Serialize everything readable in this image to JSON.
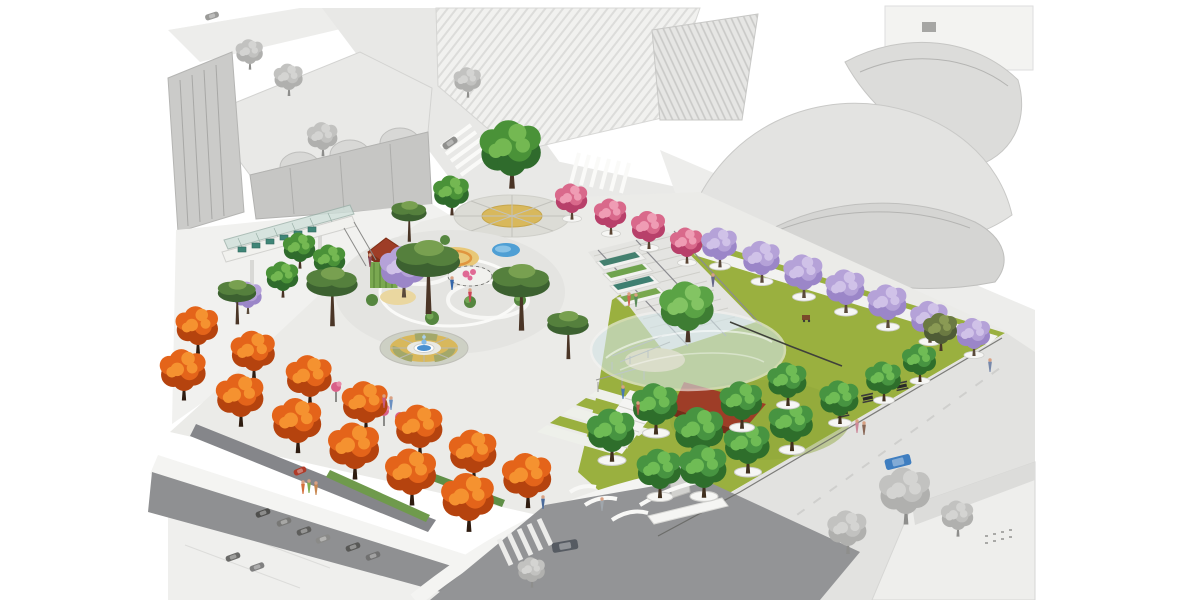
{
  "meta": {
    "title": "Aerial perspective rendering of an urban park masterplan",
    "style": "Colored park illustration over washed-out grayscale aerial photo context",
    "canvas": "1200x600"
  },
  "palette": {
    "background": "#ffffff",
    "context_gray": "#e3e3e1",
    "plaza": "#ebebe8",
    "pavement": "#f1f1ef",
    "lawn": "#9ab03f",
    "lawn_light": "#aec159",
    "street_dark": "#8f9092",
    "street_light": "#e2e2e0",
    "sidewalk": "#f4f4f2",
    "orange_foliage": "#e4641a",
    "green_foliage": "#479441",
    "jacaranda_purple": "#b5a2d8",
    "pink_blossom": "#d9698b",
    "pine_green": "#55803d",
    "canopy_glass": "#d3e4e6",
    "roof_red": "#9e3d27",
    "water_blue": "#4a90d0",
    "play_tan": "#e8c878",
    "planter_teal": "#44806f"
  },
  "scene": {
    "landmarks": [
      {
        "name": "walt-disney-concert-hall",
        "treatment": "grayscale"
      },
      {
        "name": "the-broad-museum-roof",
        "treatment": "grayscale"
      },
      {
        "name": "arched-roof-museum-block",
        "treatment": "grayscale"
      },
      {
        "name": "parking-lot",
        "treatment": "grayscale"
      },
      {
        "name": "pedestrian-bridge-with-glass-canopy"
      },
      {
        "name": "circular-glass-canopy-pavilion"
      },
      {
        "name": "terraced-lawn-amphitheater"
      },
      {
        "name": "red-shade-roof"
      },
      {
        "name": "playground-with-splash-pad"
      },
      {
        "name": "radial-paved-fountain-plaza"
      },
      {
        "name": "kiosk-with-green-living-wall"
      },
      {
        "name": "jacaranda-street-promenade"
      },
      {
        "name": "autumn-tree-lined-street"
      }
    ],
    "tree_groups": [
      {
        "id": "context-gray",
        "shape": "round",
        "planter": false,
        "trunk": "#8e8e8c",
        "colors": [
          "#b0b0ae",
          "#c2c2c0",
          "#d4d4d2"
        ],
        "trees": [
          [
            250,
            64,
            0.8
          ],
          [
            289,
            90,
            0.85
          ],
          [
            323,
            150,
            0.9
          ],
          [
            468,
            92,
            0.8
          ],
          [
            906,
            514,
            1.5
          ],
          [
            848,
            546,
            1.15
          ],
          [
            958,
            530,
            0.95
          ],
          [
            532,
            582,
            0.8
          ]
        ]
      },
      {
        "id": "green-shade",
        "shape": "round",
        "planter": false,
        "trunk": "#4a3426",
        "colors": [
          "#2f6b2c",
          "#4a9238",
          "#74b852"
        ],
        "trees": [
          [
            512,
            176,
            1.8
          ],
          [
            452,
            208,
            1.05
          ],
          [
            300,
            262,
            0.95
          ],
          [
            283,
            291,
            0.95
          ],
          [
            330,
            274,
            0.95
          ]
        ]
      },
      {
        "id": "crape-myrtle",
        "shape": "round",
        "planter": true,
        "trunk": "#5a4433",
        "colors": [
          "#b8406a",
          "#d9698b",
          "#ef9cb4"
        ],
        "trees": [
          [
            572,
            213,
            0.95
          ],
          [
            611,
            228,
            0.95
          ],
          [
            649,
            242,
            1.0
          ],
          [
            687,
            257,
            0.95
          ]
        ]
      },
      {
        "id": "jacaranda-street",
        "shape": "round",
        "planter": true,
        "trunk": "#5a4a3a",
        "colors": [
          "#9b86c8",
          "#b5a2d8",
          "#d0c2e8"
        ],
        "trees": [
          [
            720,
            260,
            1.05
          ],
          [
            762,
            275,
            1.1
          ],
          [
            804,
            290,
            1.15
          ],
          [
            846,
            305,
            1.15
          ],
          [
            888,
            320,
            1.15
          ],
          [
            930,
            335,
            1.1
          ],
          [
            974,
            349,
            1.0
          ]
        ]
      },
      {
        "id": "olive",
        "shape": "round",
        "planter": false,
        "trunk": "#4a3a2a",
        "colors": [
          "#4f5c36",
          "#6b7a42",
          "#8a9a54"
        ],
        "trees": [
          [
            941,
            344,
            1.0
          ]
        ]
      },
      {
        "id": "jacaranda-garden",
        "shape": "round",
        "planter": false,
        "trunk": "#5a4a3a",
        "colors": [
          "#9b86c8",
          "#b5a2d8",
          "#d0c2e8"
        ],
        "trees": [
          [
            404,
            288,
            1.35
          ],
          [
            248,
            308,
            0.85
          ]
        ]
      },
      {
        "id": "stone-pine",
        "shape": "pine",
        "planter": false,
        "trunk": "#4a3526",
        "colors": [
          "#3c6130",
          "#55803d",
          "#78a050"
        ],
        "trees": [
          [
            332,
            315,
            1.6
          ],
          [
            428,
            300,
            2.0
          ],
          [
            521,
            318,
            1.8
          ],
          [
            568,
            350,
            1.3
          ],
          [
            237,
            316,
            1.2
          ],
          [
            409,
            234,
            1.1
          ]
        ]
      },
      {
        "id": "canopy-tree",
        "shape": "round",
        "planter": false,
        "trunk": "#4a3426",
        "colors": [
          "#3e7d33",
          "#5aa345",
          "#83c463"
        ],
        "trees": [
          [
            688,
            331,
            1.6
          ]
        ]
      },
      {
        "id": "green-grove",
        "shape": "round",
        "planter": true,
        "trunk": "#41301f",
        "colors": [
          "#2e6e2b",
          "#479441",
          "#6fbc55"
        ],
        "trees": [
          [
            612,
            452,
            1.4
          ],
          [
            656,
            425,
            1.35
          ],
          [
            700,
            452,
            1.45
          ],
          [
            660,
            489,
            1.3
          ],
          [
            704,
            488,
            1.4
          ],
          [
            748,
            464,
            1.35
          ],
          [
            742,
            420,
            1.25
          ],
          [
            792,
            442,
            1.3
          ],
          [
            788,
            398,
            1.15
          ],
          [
            840,
            416,
            1.15
          ],
          [
            884,
            394,
            1.05
          ],
          [
            920,
            375,
            1.0
          ]
        ]
      },
      {
        "id": "orange-back",
        "shape": "round",
        "planter": false,
        "trunk": "#2e1c10",
        "colors": [
          "#b5430e",
          "#e4641a",
          "#f59230"
        ],
        "trees": [
          [
            198,
            345,
            1.25
          ],
          [
            254,
            371,
            1.3
          ],
          [
            310,
            397,
            1.35
          ],
          [
            366,
            423,
            1.35
          ],
          [
            420,
            448,
            1.4
          ],
          [
            474,
            473,
            1.4
          ],
          [
            528,
            498,
            1.45
          ]
        ]
      },
      {
        "id": "orange-front",
        "shape": "round",
        "planter": false,
        "trunk": "#2e1c10",
        "colors": [
          "#b5430e",
          "#e4641a",
          "#f59230"
        ],
        "trees": [
          [
            184,
            391,
            1.35
          ],
          [
            241,
            417,
            1.4
          ],
          [
            298,
            443,
            1.45
          ],
          [
            355,
            469,
            1.5
          ],
          [
            412,
            495,
            1.5
          ],
          [
            469,
            521,
            1.55
          ]
        ]
      }
    ],
    "people": [
      [
        303,
        488,
        "#d4703c"
      ],
      [
        309,
        487,
        "#7fae4e"
      ],
      [
        316,
        489,
        "#c8874f"
      ],
      [
        384,
        402,
        "#c75a7a"
      ],
      [
        391,
        404,
        "#6a8fc0"
      ],
      [
        370,
        261,
        "#8a4a5a"
      ],
      [
        543,
        503,
        "#4a6a9a"
      ],
      [
        602,
        505,
        "#a0a6ac"
      ],
      [
        629,
        300,
        "#cf6a55"
      ],
      [
        636,
        301,
        "#5a8a5a"
      ],
      [
        713,
        281,
        "#666688"
      ],
      [
        623,
        393,
        "#4a7ab0"
      ],
      [
        638,
        409,
        "#b05a4a"
      ],
      [
        857,
        427,
        "#cc8899"
      ],
      [
        864,
        429,
        "#886655"
      ],
      [
        470,
        296,
        "#cc4455"
      ],
      [
        452,
        284,
        "#3366aa"
      ],
      [
        990,
        366,
        "#7788aa"
      ]
    ],
    "cars": [
      {
        "x": 565,
        "y": 546,
        "w": 26,
        "h": 10,
        "c": "#565b62",
        "a": -10
      },
      {
        "x": 898,
        "y": 462,
        "w": 26,
        "h": 11,
        "c": "#3f7ec0",
        "a": -14
      },
      {
        "x": 450,
        "y": 143,
        "w": 16,
        "h": 7,
        "c": "#8f8f8d",
        "a": -35
      },
      {
        "x": 212,
        "y": 16,
        "w": 14,
        "h": 6,
        "c": "#9a9a98",
        "a": -18
      },
      {
        "x": 263,
        "y": 513,
        "w": 15,
        "h": 6,
        "c": "#4f4f4d",
        "a": -20
      },
      {
        "x": 284,
        "y": 522,
        "w": 15,
        "h": 6,
        "c": "#787876",
        "a": -20
      },
      {
        "x": 304,
        "y": 531,
        "w": 15,
        "h": 6,
        "c": "#5e5e5c",
        "a": -20
      },
      {
        "x": 323,
        "y": 539,
        "w": 15,
        "h": 6,
        "c": "#8a8a88",
        "a": -20
      },
      {
        "x": 233,
        "y": 557,
        "w": 15,
        "h": 6,
        "c": "#6a6a68",
        "a": -20
      },
      {
        "x": 257,
        "y": 567,
        "w": 15,
        "h": 6,
        "c": "#808080",
        "a": -20
      },
      {
        "x": 353,
        "y": 547,
        "w": 15,
        "h": 6,
        "c": "#585856",
        "a": -20
      },
      {
        "x": 373,
        "y": 556,
        "w": 15,
        "h": 6,
        "c": "#707070",
        "a": -20
      },
      {
        "x": 300,
        "y": 471,
        "w": 13,
        "h": 6,
        "c": "#b03a28",
        "a": -23
      }
    ],
    "picnic_tables": [
      [
        868,
        399
      ],
      [
        902,
        387
      ],
      [
        843,
        414
      ]
    ]
  }
}
